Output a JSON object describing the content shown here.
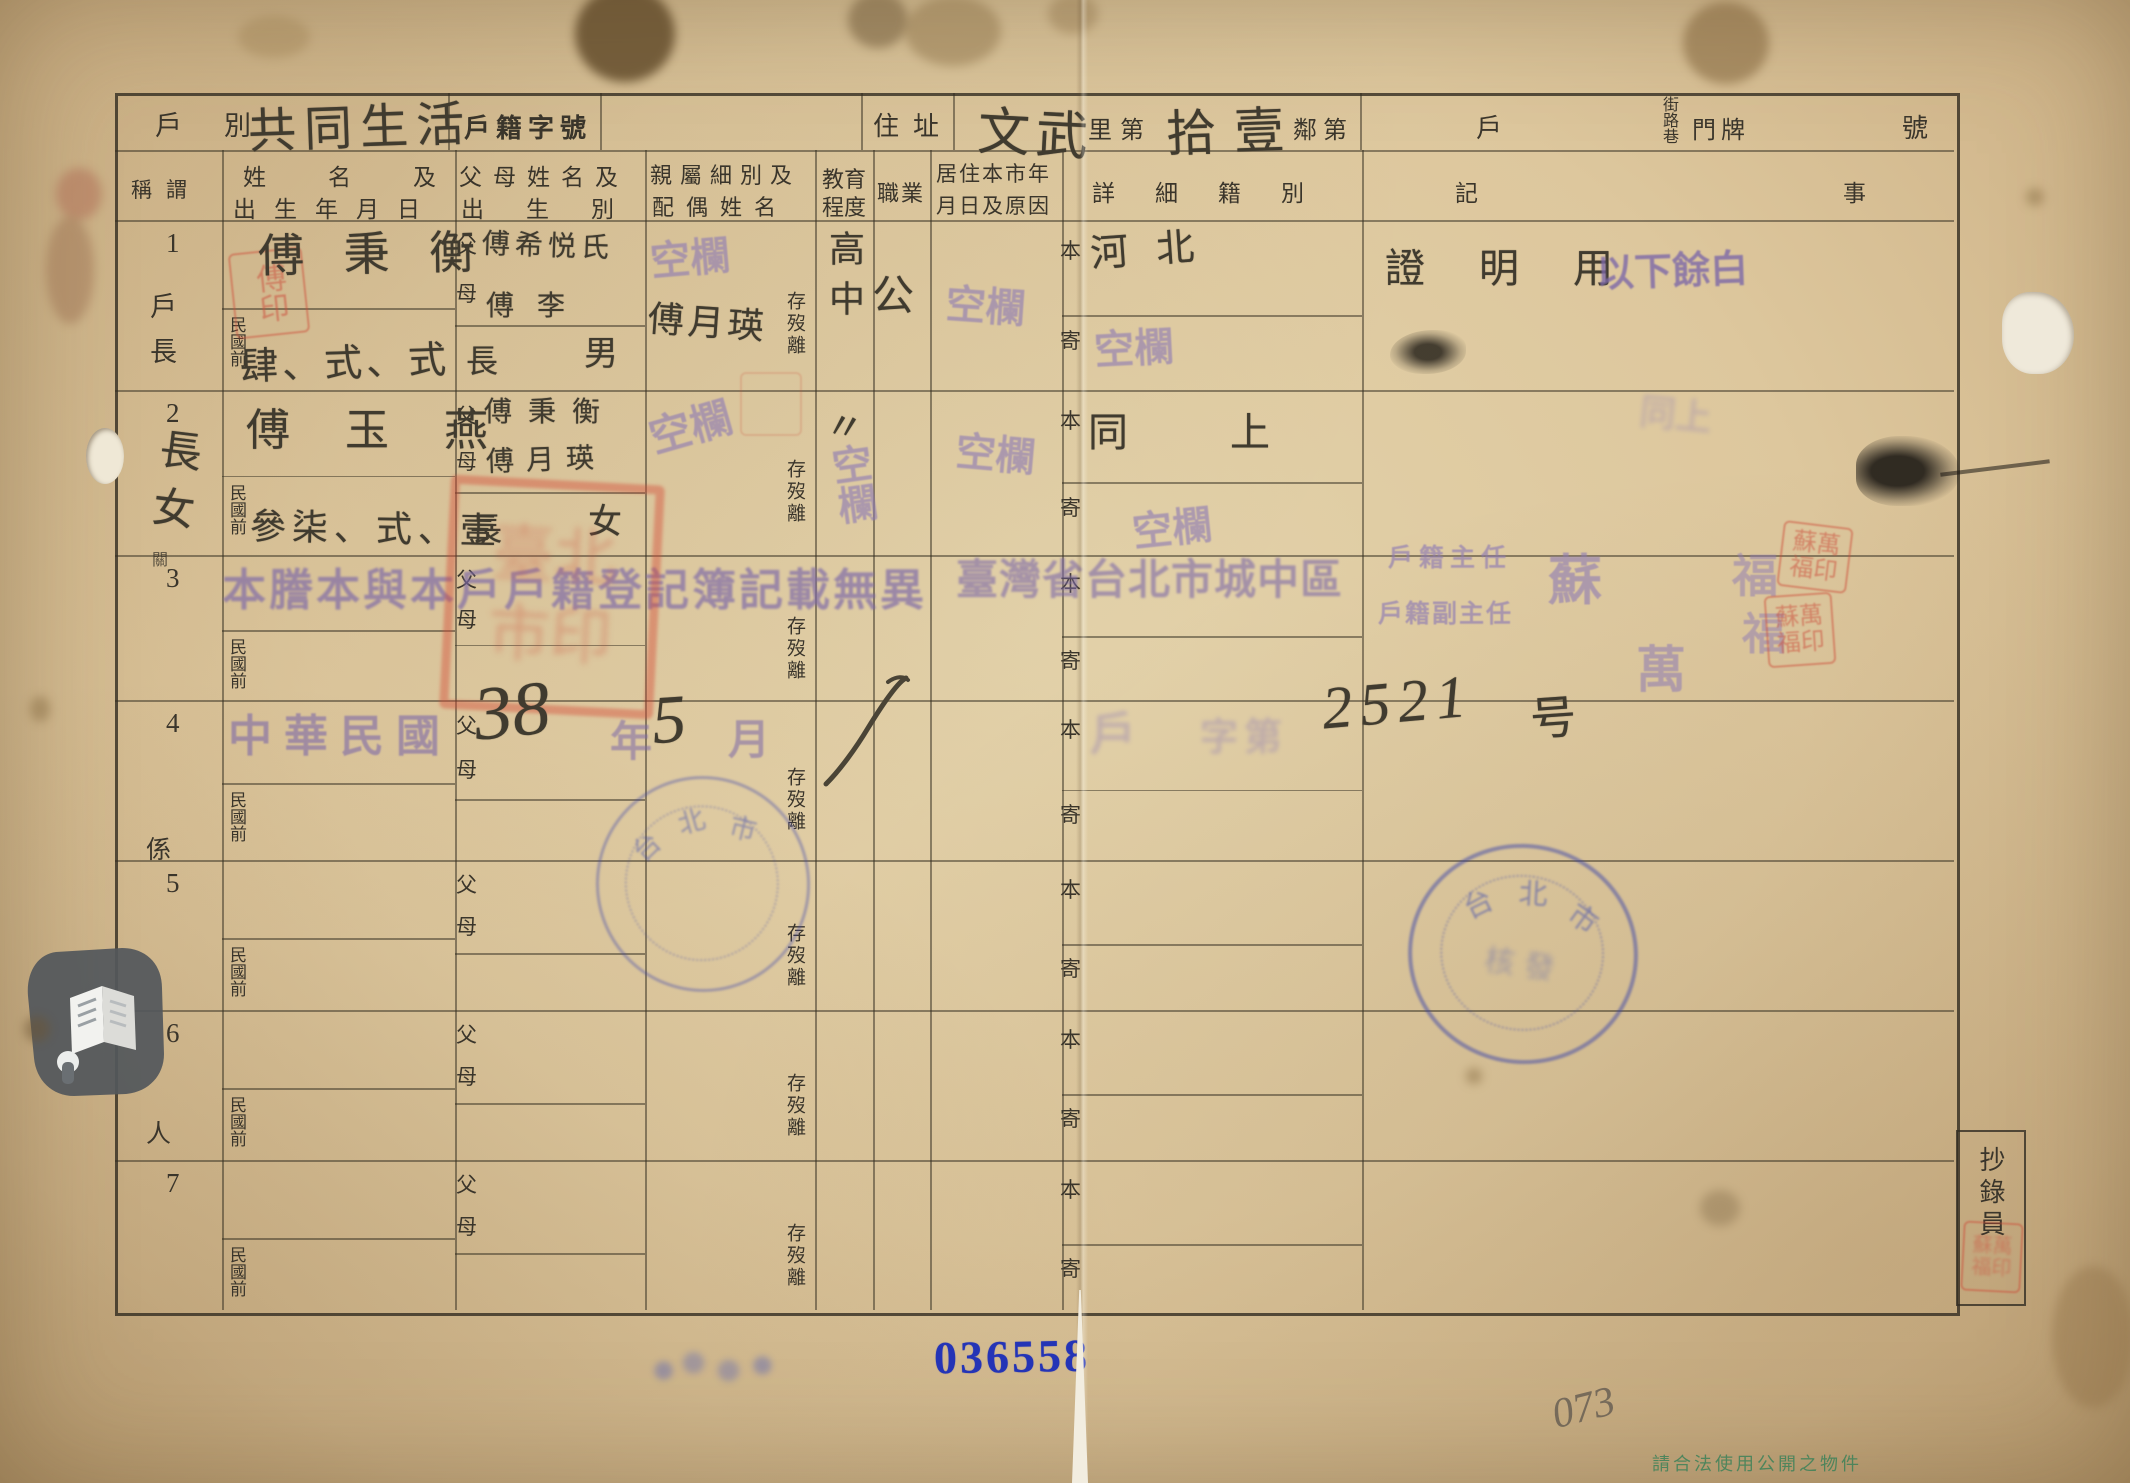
{
  "page": {
    "serial": "036558",
    "pencil_note": "073",
    "watermark": "請合法使用公開之物件"
  },
  "header": {
    "hu_bie_label": "戶別",
    "hu_bie_value": "共同生活",
    "hu_ji_zi_hao_label": "戶籍字號",
    "zhu_zhi_label": "住址",
    "zhu_zhi_value_1": "文武",
    "li_di_label": "里第",
    "zhu_zhi_value_2": "拾壹",
    "lin_di_label": "鄰第",
    "hu_label": "戶",
    "jie_lu_xiang_label": "街路巷",
    "men_pai_label": "門牌",
    "hao_label": "號"
  },
  "columns": {
    "c1": "稱謂",
    "c2a": "姓名及",
    "c2b": "出生年月日",
    "c3a": "父母姓名及",
    "c3b": "出生別",
    "c4a": "親屬細別及",
    "c4b": "配偶姓名",
    "c5a": "教育",
    "c5b": "程度",
    "c6": "職業",
    "c7a": "居住本市年",
    "c7b": "月日及原因",
    "c8": "詳細籍別",
    "c9a": "記",
    "c9b": "事"
  },
  "form_labels": {
    "minguo_qian": "民國前",
    "father": "父",
    "mother": "母",
    "cun_mo_li": "存歿離",
    "ben": "本",
    "ji": "寄"
  },
  "margin": {
    "m1": "關",
    "m2": "係",
    "m3": "人"
  },
  "rows": [
    {
      "num": "1",
      "title": "戶長",
      "name": "傅 秉 衡",
      "date": "肆、式、式",
      "father": "傅希悦氏",
      "mother": "傅 李",
      "birth1": "長",
      "birth2": "男",
      "spouse": "傅月瑛",
      "education": "高中",
      "occupation": "公",
      "origin": "河北",
      "note": "證 明 用"
    },
    {
      "num": "2",
      "title": "長女",
      "name": "傅 玉 燕",
      "date": "參柒、式、壹",
      "father": "傅秉衡",
      "mother": "傅月瑛",
      "birth1": "長",
      "birth2": "女",
      "occupation": "〃",
      "origin": "同  上"
    },
    {
      "num": "3"
    },
    {
      "num": "4"
    },
    {
      "num": "5"
    },
    {
      "num": "6"
    },
    {
      "num": "7"
    }
  ],
  "stamps": {
    "kong_lan": "空欄",
    "yi_xia_yu_bai": "以下餘白",
    "tengben_banner": "本謄本與本戶戶籍登記簿記載無異",
    "district_line": "臺灣省台北市城中區",
    "chief": "戶籍主任",
    "deputy": "戶籍副主任",
    "signer_1": "蘇",
    "signer_2": "萬",
    "signer_3": "福",
    "signer_4": "福",
    "minguo_stamp": "中華民國",
    "year_label": "年",
    "month_label": "月",
    "hand_year": "38",
    "hand_month": "5",
    "hu_char": "戶",
    "zi_di": "字第",
    "hand_serial": "2521",
    "hao_char": "号",
    "tong_shang_ghost": "同上",
    "small_seal_row1": "傅印",
    "big_seal": "臺北市印",
    "su_seal": "蘇萬福印",
    "copyist_seal": "蘇萬福印",
    "round_left_chars": "台北市",
    "round_right_chars": "台北市",
    "round_right_center": "核發"
  },
  "copyist": {
    "label": "抄錄員"
  }
}
